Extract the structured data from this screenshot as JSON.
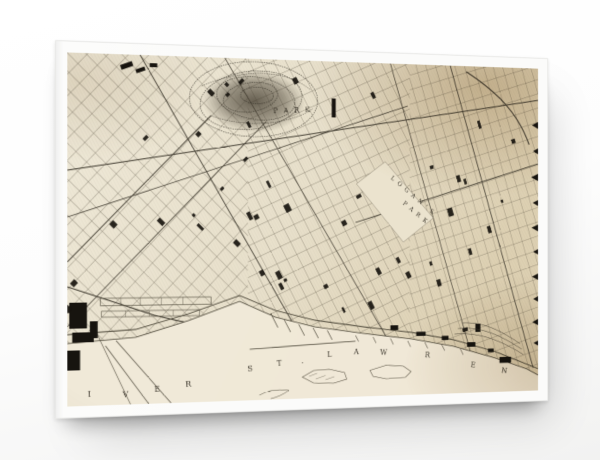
{
  "scene": {
    "description": "framed antique city map product photo",
    "background_color": "#f6f6f5",
    "frame_color": "#fbfbfa",
    "frame_edge_color": "#e8e8e6"
  },
  "map": {
    "paper_color": "#ece4d0",
    "paper_dark_color": "#ddd0b2",
    "river_color": "#f0e9d8",
    "ink_color": "#4d4738",
    "black_ink_color": "#17140f",
    "label_color": "#3a352b",
    "features": [
      "dense-street-grid",
      "hachured-mountain",
      "harbour-wharves",
      "islands-in-river",
      "river-st-lawrence"
    ],
    "texture": {
      "building_count": 46,
      "seed": 11
    },
    "svg_texts": [
      {
        "name": "label-mount-royal-park",
        "text": "P A R K",
        "x": 436,
        "y": 112,
        "rot": -3,
        "size": 15,
        "ls": 4
      },
      {
        "name": "label-logans-park-1",
        "text": "L O G A N ' S",
        "x": 700,
        "y": 246,
        "rot": 38,
        "size": 13,
        "ls": 3
      },
      {
        "name": "label-logans-park-2",
        "text": "P A R K",
        "x": 728,
        "y": 300,
        "rot": 38,
        "size": 13,
        "ls": 3
      },
      {
        "name": "river-letter-i",
        "text": "I",
        "x": 42,
        "y": 692,
        "rot": -2,
        "size": 16,
        "ls": 0
      },
      {
        "name": "river-letter-v",
        "text": "V",
        "x": 114,
        "y": 695,
        "rot": -2,
        "size": 16,
        "ls": 0
      },
      {
        "name": "river-letter-e1",
        "text": "E",
        "x": 180,
        "y": 686,
        "rot": -3,
        "size": 16,
        "ls": 0
      },
      {
        "name": "river-letter-r1",
        "text": "R",
        "x": 246,
        "y": 678,
        "rot": -3,
        "size": 16,
        "ls": 0
      },
      {
        "name": "river-letter-s",
        "text": "S",
        "x": 380,
        "y": 650,
        "rot": -5,
        "size": 16,
        "ls": 0
      },
      {
        "name": "river-letter-t",
        "text": "T",
        "x": 444,
        "y": 640,
        "rot": -4,
        "size": 16,
        "ls": 0
      },
      {
        "name": "river-letter-dot",
        "text": ".",
        "x": 498,
        "y": 636,
        "rot": 0,
        "size": 16,
        "ls": 0
      },
      {
        "name": "river-letter-l",
        "text": "L",
        "x": 556,
        "y": 624,
        "rot": -2,
        "size": 16,
        "ls": 0
      },
      {
        "name": "river-letter-a",
        "text": "A",
        "x": 616,
        "y": 620,
        "rot": 0,
        "size": 16,
        "ls": 0
      },
      {
        "name": "river-letter-w",
        "text": "W",
        "x": 676,
        "y": 622,
        "rot": 2,
        "size": 16,
        "ls": 0
      },
      {
        "name": "river-letter-r2",
        "text": "R",
        "x": 780,
        "y": 630,
        "rot": 4,
        "size": 16,
        "ls": 0
      },
      {
        "name": "river-letter-e2",
        "text": "E",
        "x": 888,
        "y": 654,
        "rot": 7,
        "size": 16,
        "ls": 0
      },
      {
        "name": "river-letter-n",
        "text": "N",
        "x": 962,
        "y": 668,
        "rot": 8,
        "size": 16,
        "ls": 0
      }
    ]
  }
}
